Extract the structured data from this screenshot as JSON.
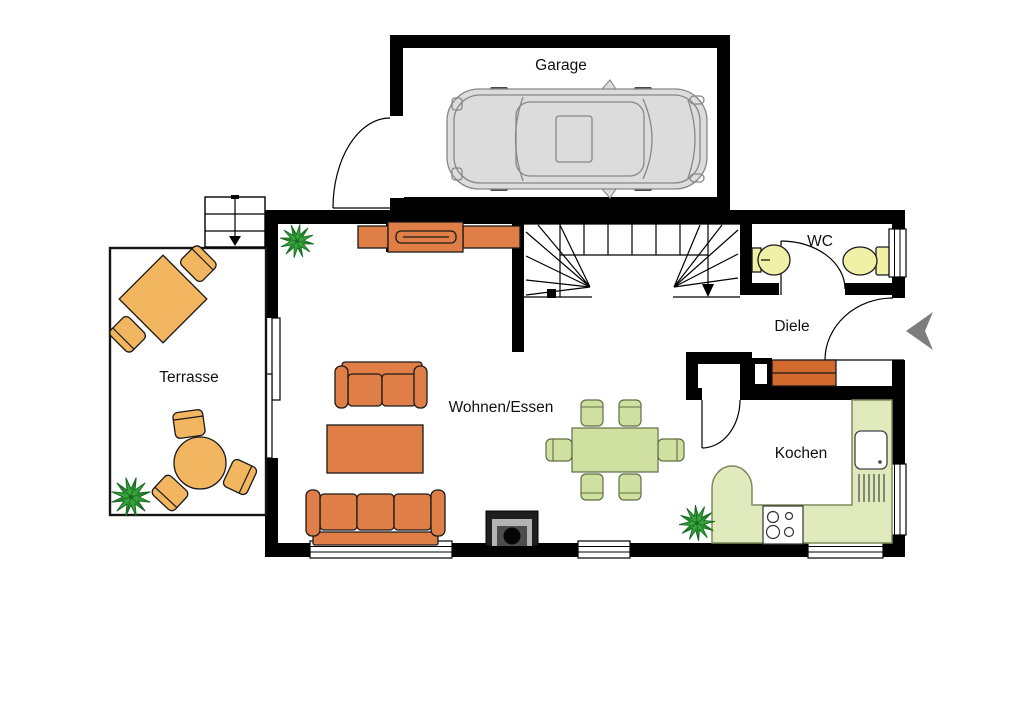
{
  "rooms": {
    "garage": {
      "label": "Garage"
    },
    "wc": {
      "label": "WC"
    },
    "diele": {
      "label": "Diele"
    },
    "terrasse": {
      "label": "Terrasse"
    },
    "wohnen_essen": {
      "label": "Wohnen/Essen"
    },
    "kochen": {
      "label": "Kochen"
    }
  },
  "colors": {
    "wall": "#000000",
    "sofa_orange": "#df7f47",
    "cabinet_orange": "#d2692f",
    "terrace_tan": "#f2b660",
    "dining_green": "#cfe0a0",
    "counter_green": "#e0eabc",
    "fixture_yellow": "#f0f0a6",
    "plant_green": "#35a23c",
    "car_gray": "#dcdcdc",
    "stove_dark": "#1f1f1f",
    "arrow_gray": "#7d7d7d"
  },
  "symbols": {
    "car": "car-top-view",
    "staircase": "u-stair-with-down-arrow",
    "exterior_steps": "three-steps-with-arrow",
    "entrance": "entrance-direction-arrow",
    "stove": "wood-stove",
    "sink_unit": "kitchen-sink-with-drainer",
    "cooktop": "4-burner-cooktop",
    "washbasin": "wc-washbasin",
    "toilet": "toilet-with-tank",
    "plant": "potted-plant",
    "sliding_door": "terrace-sliding-door"
  }
}
